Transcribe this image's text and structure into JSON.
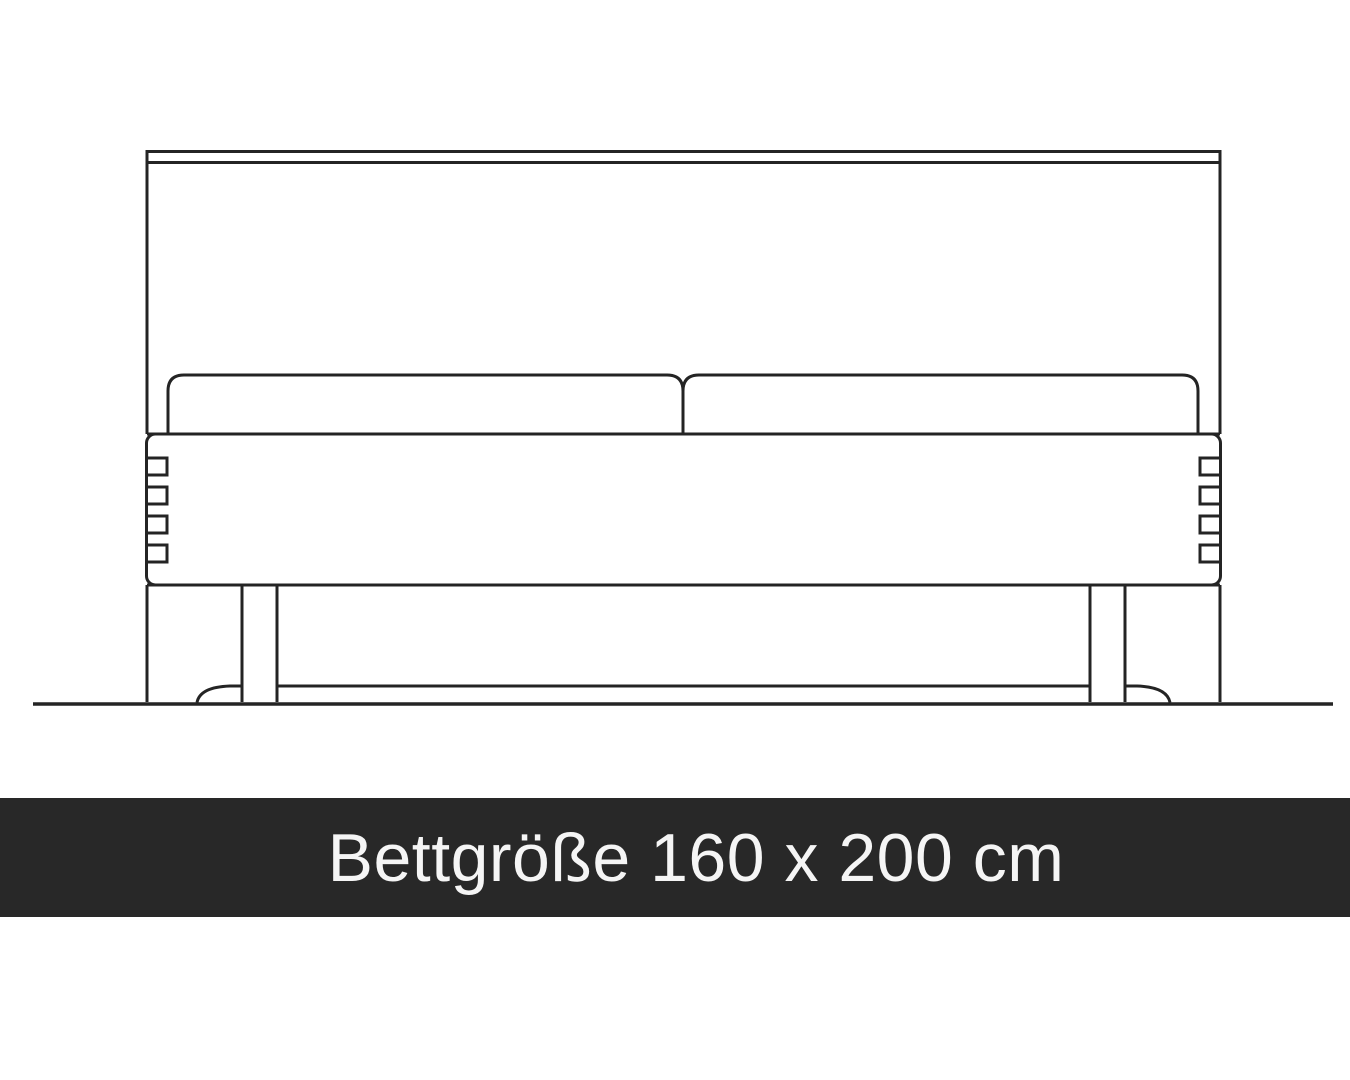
{
  "page": {
    "background_color": "#ffffff"
  },
  "illustration": {
    "type": "bed-front-view-line-drawing",
    "line_color": "#242424",
    "parts": [
      "headboard",
      "headboard-trim",
      "pillow-left",
      "pillow-right",
      "upholstered-frame",
      "frame-side-slats",
      "leg-left",
      "leg-right",
      "under-bed-rail",
      "rear-foot-arc-left",
      "rear-foot-arc-right",
      "floor-line"
    ],
    "pillow_count": 2
  },
  "banner": {
    "label": "Bettgröße 160 x 200 cm",
    "background_color": "#282828",
    "text_color": "#f5f5f5",
    "bed_width_cm": 160,
    "bed_length_cm": 200,
    "unit": "cm"
  }
}
